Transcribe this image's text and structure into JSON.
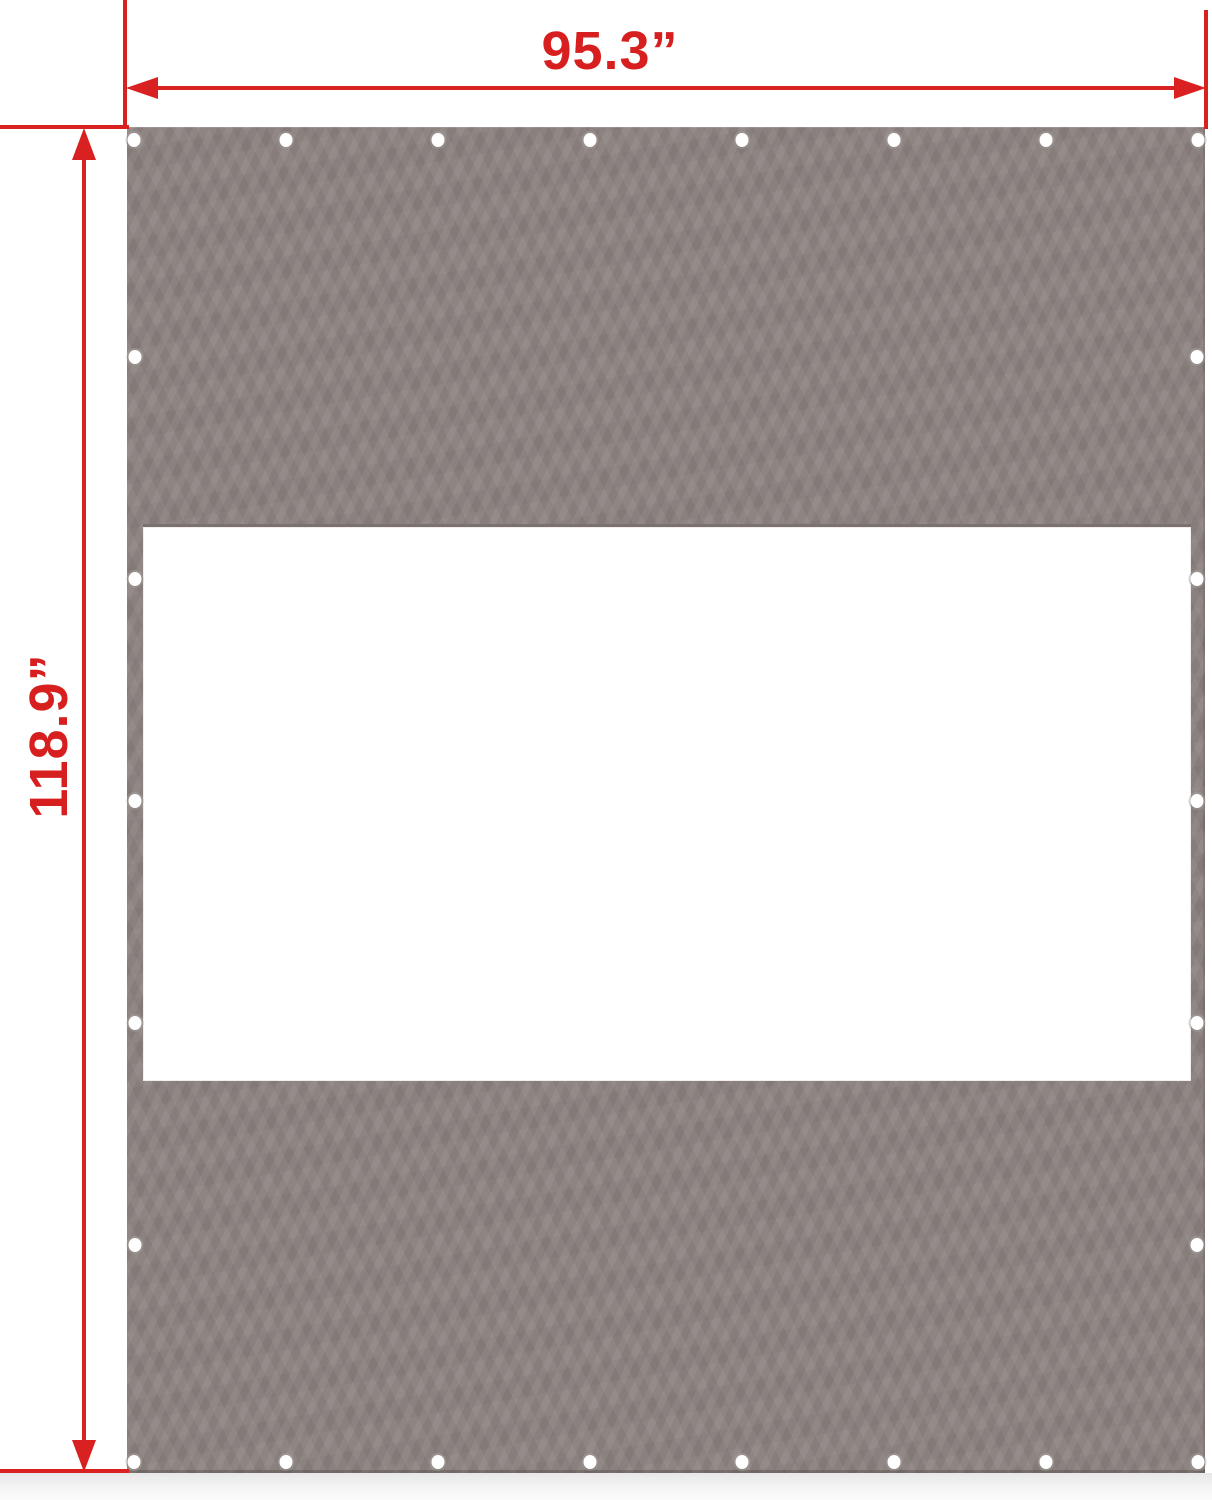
{
  "diagram": {
    "kind": "product-dimension-diagram",
    "subject": "canopy-sidewall-tarp-panel-with-window-cutout",
    "dimensions": {
      "width_label": "95.3”",
      "height_label": "118.9”"
    },
    "colors": {
      "tarp_gray": "#8b827f",
      "window_white": "#ffffff",
      "seam_dark": "#7b7270",
      "dimension_red": "#d92121",
      "grommet_white": "#ffffff",
      "floor_shadow": "#e9e8e9"
    },
    "grommets": {
      "diameter_px": 13,
      "rows": [
        {
          "name": "top-edge",
          "count": 8,
          "y": 140,
          "x_start": 134,
          "x_end": 1198
        },
        {
          "name": "bottom-edge",
          "count": 8,
          "y": 1462,
          "x_start": 134,
          "x_end": 1198
        }
      ],
      "columns": [
        {
          "name": "left-edge",
          "count": 5,
          "x": 135,
          "y_start": 357,
          "y_end": 1245
        },
        {
          "name": "right-edge",
          "count": 5,
          "x": 1197,
          "y_start": 357,
          "y_end": 1245
        }
      ]
    }
  }
}
